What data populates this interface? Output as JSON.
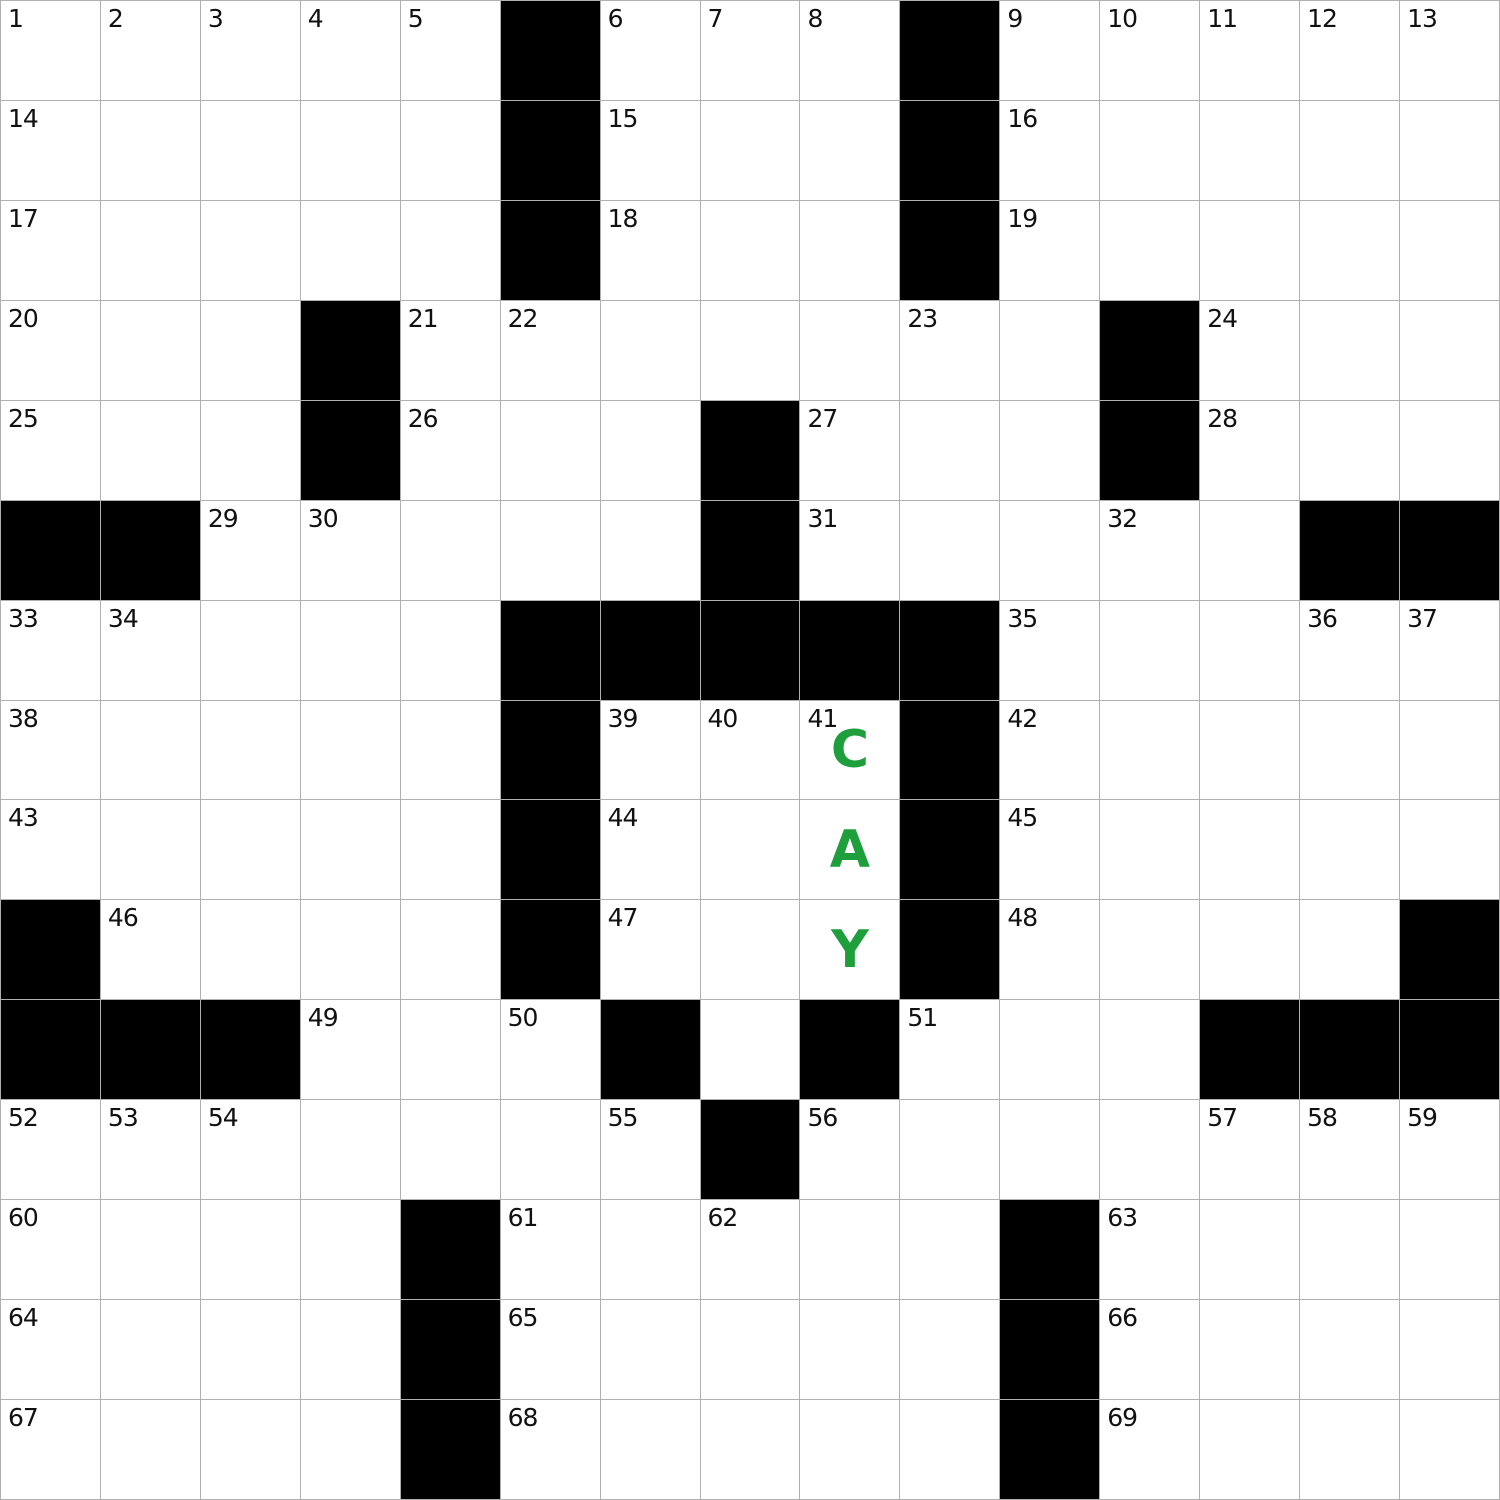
{
  "colors": {
    "background": "#ffffff",
    "grid_line": "#b0b0b0",
    "black_cell": "#000000",
    "white_cell": "#ffffff",
    "number_text": "#111111",
    "letter_text": "#1f9e3c"
  },
  "grid": {
    "rows": 15,
    "cols": 15,
    "black_cells": [
      ".....#...#.....",
      ".....#...#.....",
      ".....#...#.....",
      "...#.......#...",
      "...#...#...#...",
      "##.....#.....##",
      ".....#####.....",
      ".....#...#.....",
      ".....#...#.....",
      "#....#...#....#",
      "###...#.#...###",
      ".......#.......",
      "....#.....#....",
      "....#.....#....",
      "....#.....#...."
    ],
    "numbers": [
      {
        "r": 0,
        "c": 0,
        "n": "1"
      },
      {
        "r": 0,
        "c": 1,
        "n": "2"
      },
      {
        "r": 0,
        "c": 2,
        "n": "3"
      },
      {
        "r": 0,
        "c": 3,
        "n": "4"
      },
      {
        "r": 0,
        "c": 4,
        "n": "5"
      },
      {
        "r": 0,
        "c": 6,
        "n": "6"
      },
      {
        "r": 0,
        "c": 7,
        "n": "7"
      },
      {
        "r": 0,
        "c": 8,
        "n": "8"
      },
      {
        "r": 0,
        "c": 10,
        "n": "9"
      },
      {
        "r": 0,
        "c": 11,
        "n": "10"
      },
      {
        "r": 0,
        "c": 12,
        "n": "11"
      },
      {
        "r": 0,
        "c": 13,
        "n": "12"
      },
      {
        "r": 0,
        "c": 14,
        "n": "13"
      },
      {
        "r": 1,
        "c": 0,
        "n": "14"
      },
      {
        "r": 1,
        "c": 6,
        "n": "15"
      },
      {
        "r": 1,
        "c": 10,
        "n": "16"
      },
      {
        "r": 2,
        "c": 0,
        "n": "17"
      },
      {
        "r": 2,
        "c": 6,
        "n": "18"
      },
      {
        "r": 2,
        "c": 10,
        "n": "19"
      },
      {
        "r": 3,
        "c": 0,
        "n": "20"
      },
      {
        "r": 3,
        "c": 4,
        "n": "21"
      },
      {
        "r": 3,
        "c": 5,
        "n": "22"
      },
      {
        "r": 3,
        "c": 9,
        "n": "23"
      },
      {
        "r": 3,
        "c": 12,
        "n": "24"
      },
      {
        "r": 4,
        "c": 0,
        "n": "25"
      },
      {
        "r": 4,
        "c": 4,
        "n": "26"
      },
      {
        "r": 4,
        "c": 8,
        "n": "27"
      },
      {
        "r": 4,
        "c": 12,
        "n": "28"
      },
      {
        "r": 5,
        "c": 2,
        "n": "29"
      },
      {
        "r": 5,
        "c": 3,
        "n": "30"
      },
      {
        "r": 5,
        "c": 8,
        "n": "31"
      },
      {
        "r": 5,
        "c": 11,
        "n": "32"
      },
      {
        "r": 6,
        "c": 0,
        "n": "33"
      },
      {
        "r": 6,
        "c": 1,
        "n": "34"
      },
      {
        "r": 6,
        "c": 10,
        "n": "35"
      },
      {
        "r": 6,
        "c": 13,
        "n": "36"
      },
      {
        "r": 6,
        "c": 14,
        "n": "37"
      },
      {
        "r": 7,
        "c": 0,
        "n": "38"
      },
      {
        "r": 7,
        "c": 6,
        "n": "39"
      },
      {
        "r": 7,
        "c": 7,
        "n": "40"
      },
      {
        "r": 7,
        "c": 8,
        "n": "41"
      },
      {
        "r": 7,
        "c": 10,
        "n": "42"
      },
      {
        "r": 8,
        "c": 0,
        "n": "43"
      },
      {
        "r": 8,
        "c": 6,
        "n": "44"
      },
      {
        "r": 8,
        "c": 10,
        "n": "45"
      },
      {
        "r": 9,
        "c": 1,
        "n": "46"
      },
      {
        "r": 9,
        "c": 6,
        "n": "47"
      },
      {
        "r": 9,
        "c": 10,
        "n": "48"
      },
      {
        "r": 10,
        "c": 3,
        "n": "49"
      },
      {
        "r": 10,
        "c": 5,
        "n": "50"
      },
      {
        "r": 10,
        "c": 9,
        "n": "51"
      },
      {
        "r": 11,
        "c": 0,
        "n": "52"
      },
      {
        "r": 11,
        "c": 1,
        "n": "53"
      },
      {
        "r": 11,
        "c": 2,
        "n": "54"
      },
      {
        "r": 11,
        "c": 6,
        "n": "55"
      },
      {
        "r": 11,
        "c": 8,
        "n": "56"
      },
      {
        "r": 11,
        "c": 12,
        "n": "57"
      },
      {
        "r": 11,
        "c": 13,
        "n": "58"
      },
      {
        "r": 11,
        "c": 14,
        "n": "59"
      },
      {
        "r": 12,
        "c": 0,
        "n": "60"
      },
      {
        "r": 12,
        "c": 5,
        "n": "61"
      },
      {
        "r": 12,
        "c": 7,
        "n": "62"
      },
      {
        "r": 12,
        "c": 11,
        "n": "63"
      },
      {
        "r": 13,
        "c": 0,
        "n": "64"
      },
      {
        "r": 13,
        "c": 5,
        "n": "65"
      },
      {
        "r": 13,
        "c": 11,
        "n": "66"
      },
      {
        "r": 14,
        "c": 0,
        "n": "67"
      },
      {
        "r": 14,
        "c": 5,
        "n": "68"
      },
      {
        "r": 14,
        "c": 11,
        "n": "69"
      }
    ],
    "entries": [
      {
        "r": 7,
        "c": 8,
        "letter": "C"
      },
      {
        "r": 8,
        "c": 8,
        "letter": "A"
      },
      {
        "r": 9,
        "c": 8,
        "letter": "Y"
      }
    ]
  }
}
